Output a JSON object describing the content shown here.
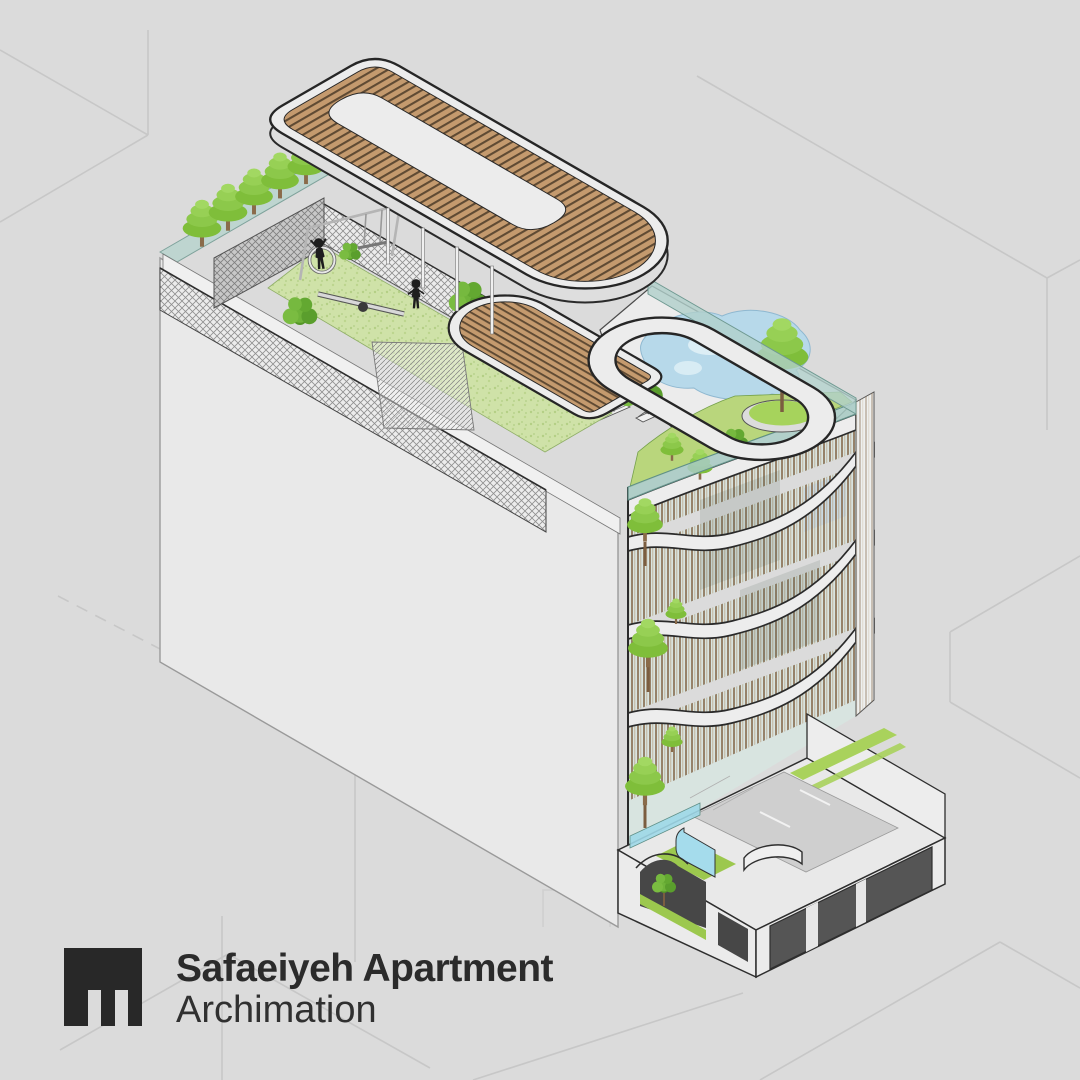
{
  "brand": {
    "title": "Safaeiyeh Apartment",
    "studio": "Archimation",
    "logo_icon": "m-mark-logo"
  },
  "palette": {
    "background": "#dbdbdb",
    "ink": "#2b2b2b",
    "faint_line": "#c7c7c7",
    "surface_white": "#ececec",
    "outline_black": "#262626",
    "wood": "#c49a6e",
    "wood_line": "#5f4a33",
    "lawn": "#cfe2a8",
    "tree_green": "#8cc63f",
    "leaf_dark": "#5a9e2d",
    "pool_water": "#b7d9ea",
    "glass_teal": "#b9d5cf",
    "cyan_wall": "#a5dcec",
    "garage_gray": "#555555"
  }
}
